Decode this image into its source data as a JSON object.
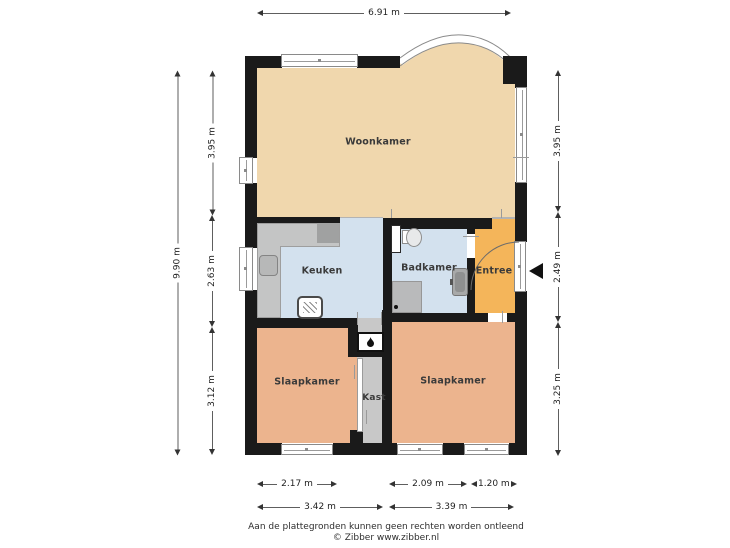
{
  "rooms": {
    "living": "Woonkamer",
    "kitchen": "Keuken",
    "bathroom": "Badkamer",
    "entry": "Entree",
    "bedroom_left": "Slaapkamer",
    "closet": "Kast",
    "bedroom_right": "Slaapkamer"
  },
  "dimensions": {
    "top_width": "6.91 m",
    "left_total": "9.90 m",
    "left_top": "3.95 m",
    "left_mid": "2.63 m",
    "left_bottom": "3.12 m",
    "right_top": "3.95 m",
    "right_mid": "2.49 m",
    "right_bottom": "3.25 m",
    "bottom_row1_left": "2.17 m",
    "bottom_row1_mid": "2.09 m",
    "bottom_row1_right": "1.20 m",
    "bottom_row2_left": "3.42 m",
    "bottom_row2_right": "3.39 m"
  },
  "footer": {
    "disclaimer": "Aan de plattegronden kunnen geen rechten worden ontleend",
    "credit": "© Zibber www.zibber.nl"
  },
  "colors": {
    "wall": "#1a1a1a",
    "living_room": "#f0d7ad",
    "bedroom": "#ecb48e",
    "entry": "#f4b55a",
    "wet_room": "#d3e1ee",
    "closet_floor": "#c8c8c8",
    "counter": "#c4c5c5",
    "window_frame": "#8a8a8a"
  },
  "icons": {
    "entrance_marker": "left-pointing-triangle",
    "boiler": "flame-icon",
    "stove": "hatched-appliance"
  }
}
